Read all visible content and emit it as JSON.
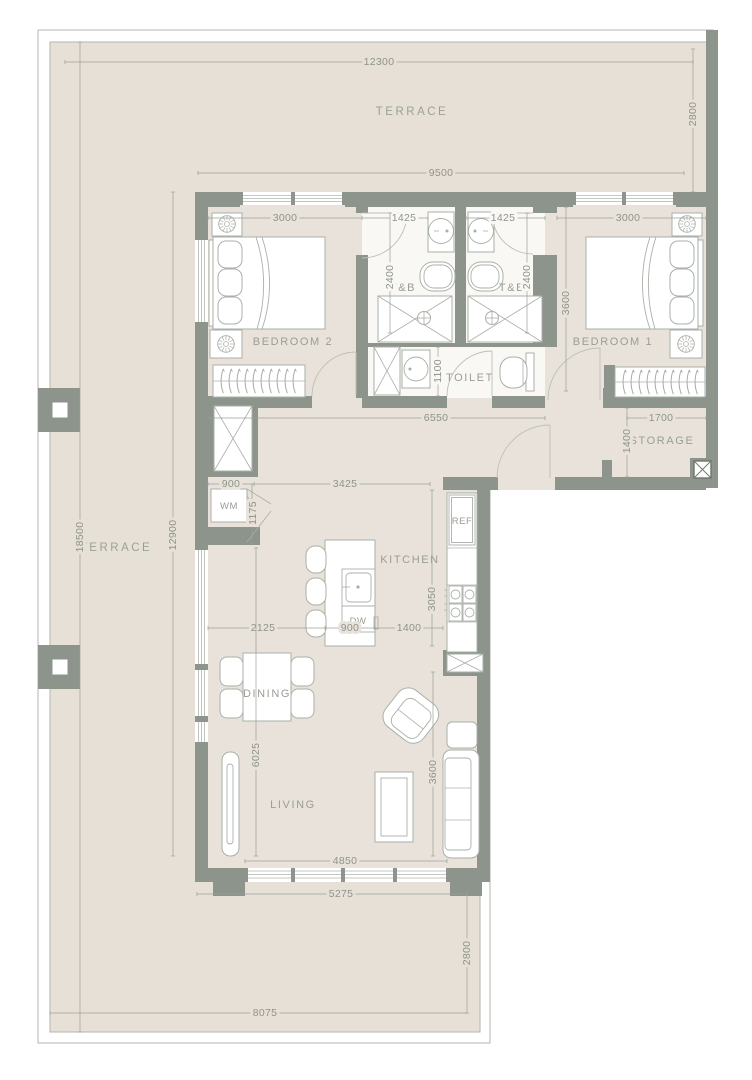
{
  "floor_plan": {
    "title": "Apartment floor plan with wrap-around terrace",
    "labels": {
      "terrace_top": "TERRACE",
      "terrace_left": "TERRACE",
      "bedroom2": "BEDROOM 2",
      "bedroom1": "BEDROOM 1",
      "tb_left": "T&B",
      "tb_right": "T&B",
      "toilet": "TOILET",
      "storage": "STORAGE",
      "kitchen": "KITCHEN",
      "dining": "DINING",
      "living": "LIVING",
      "washing_machine": "WM",
      "refrigerator": "REF",
      "dishwasher": "DW"
    },
    "dims": {
      "d12300": "12300",
      "d2800_top": "2800",
      "d9500": "9500",
      "d3000_b2": "3000",
      "d1425_l": "1425",
      "d1425_r": "1425",
      "d3000_b1": "3000",
      "d2400_l": "2400",
      "d2400_r": "2400",
      "d3600_b1": "3600",
      "d1100": "1100",
      "d6550": "6550",
      "d1700": "1700",
      "d1400_storage": "1400",
      "d18500": "18500",
      "d12900": "12900",
      "d900_wm": "900",
      "d3425": "3425",
      "d1175": "1175",
      "d3050": "3050",
      "d2125": "2125",
      "d900_island": "900",
      "d1400_kitchen": "1400",
      "d6025": "6025",
      "d3600_living": "3600",
      "d4850": "4850",
      "d5275": "5275",
      "d2800_bottom": "2800",
      "d8075": "8075"
    },
    "colors": {
      "wall": "#8c948c",
      "wall-dark": "#6f766e",
      "floor": "#e9e2da",
      "terrace": "#e7e0d7",
      "bath": "#faf8f5",
      "line": "#aab0a8",
      "dim-line": "#9aa098",
      "dim-text": "#8d938b"
    }
  }
}
